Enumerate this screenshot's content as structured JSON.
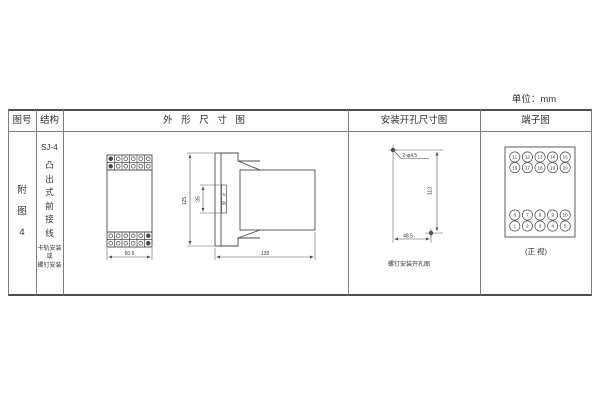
{
  "unit_label": "单位：mm",
  "headers": {
    "figure_no": "图号",
    "structure": "结构",
    "outline": "外 形 尺 寸 图",
    "mounting": "安装开孔尺寸图",
    "terminal": "端子图"
  },
  "figure_no": {
    "chars": [
      "附",
      "图",
      "4"
    ]
  },
  "structure": {
    "model": "SJ-4",
    "type_chars": [
      "凸",
      "出",
      "式",
      "前",
      "接",
      "线"
    ],
    "mount_note_lines": [
      "卡轨安装",
      "或",
      "螺钉安装"
    ]
  },
  "outline": {
    "front": {
      "width_dim": "60.5"
    },
    "side": {
      "height_dim": "125",
      "rail_dim": "35",
      "rail_chars": [
        "卡",
        "轨"
      ],
      "depth_dim": "128"
    }
  },
  "mounting": {
    "hole_label": "2-φ4.5",
    "vertical_dim": "113",
    "horizontal_dim": "48.5",
    "caption": "螺钉安装开孔图"
  },
  "terminal": {
    "rows_top": [
      [
        "11",
        "12",
        "13",
        "14",
        "15"
      ],
      [
        "16",
        "17",
        "18",
        "19",
        "20"
      ]
    ],
    "rows_bottom": [
      [
        "6",
        "7",
        "8",
        "9",
        "10"
      ],
      [
        "1",
        "2",
        "3",
        "4",
        "5"
      ]
    ],
    "caption": "(正 视)"
  },
  "colors": {
    "line": "#4a4a4a",
    "grid": "#7d7d7d",
    "text": "#333333",
    "background": "#ffffff"
  }
}
